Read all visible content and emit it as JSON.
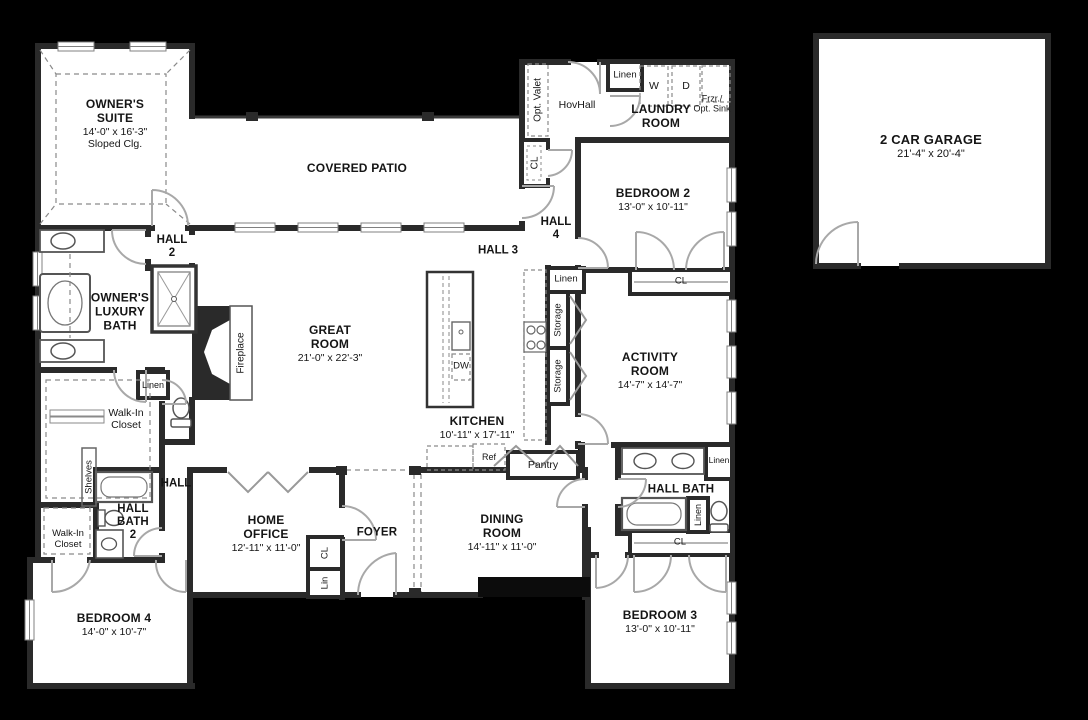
{
  "colors": {
    "background": "#000000",
    "floor": "#ffffff",
    "wall": "#2a2a2a",
    "door_swing": "#a8a8a8"
  },
  "rooms": {
    "owners_suite": {
      "name": "OWNER'S SUITE",
      "dims": "14'-0\" x 16'-3\"",
      "note": "Sloped Clg."
    },
    "covered_patio": {
      "name": "COVERED PATIO"
    },
    "laundry_room": {
      "name": "LAUNDRY ROOM"
    },
    "hovhall": {
      "name": "HovHall"
    },
    "bedroom_2": {
      "name": "BEDROOM 2",
      "dims": "13'-0\" x 10'-11\""
    },
    "great_room": {
      "name": "GREAT ROOM",
      "dims": "21'-0\" x 22'-3\""
    },
    "kitchen": {
      "name": "KITCHEN",
      "dims": "10'-11\" x 17'-11\""
    },
    "activity_room": {
      "name": "ACTIVITY ROOM",
      "dims": "14'-7\" x 14'-7\""
    },
    "owners_luxury_bath": {
      "name": "OWNER'S LUXURY BATH"
    },
    "walk_in_closet_owner": {
      "name": "Walk-In Closet"
    },
    "home_office": {
      "name": "HOME OFFICE",
      "dims": "12'-11\" x 11'-0\""
    },
    "foyer": {
      "name": "FOYER"
    },
    "dining_room": {
      "name": "DINING ROOM",
      "dims": "14'-11\" x 11'-0\""
    },
    "hall_bath": {
      "name": "HALL BATH"
    },
    "hall_bath_2": {
      "name": "HALL BATH 2"
    },
    "walk_in_closet_bed4": {
      "name": "Walk-In Closet"
    },
    "bedroom_3": {
      "name": "BEDROOM 3",
      "dims": "13'-0\" x 10'-11\""
    },
    "bedroom_4": {
      "name": "BEDROOM 4",
      "dims": "14'-0\" x 10'-7\""
    },
    "garage": {
      "name": "2 CAR GARAGE",
      "dims": "21'-4\" x 20'-4\""
    }
  },
  "halls": {
    "hall": "HALL",
    "hall_2": "HALL 2",
    "hall_3": "HALL 3",
    "hall_4": "HALL 4"
  },
  "closets": {
    "linen_laundry": "Linen",
    "linen_kitchen": "Linen",
    "linen_owner": "Linen",
    "linen_hall_bath_entry": "Linen",
    "linen_hall_bath": "Linen",
    "cl_hovhall": "CL",
    "cl_bedroom_2": "CL",
    "cl_bedroom_3": "CL",
    "cl_office": "CL",
    "lin_office": "Lin",
    "storage_upper": "Storage",
    "storage_lower": "Storage",
    "shelves": "Shelves",
    "pantry": "Pantry"
  },
  "fixtures": {
    "washer": "W",
    "dryer": "D",
    "freezer_line1": "Frzr./",
    "freezer_line2": "Opt. Sink",
    "opt_valet": "Opt. Valet",
    "dishwasher": "DW",
    "refrigerator": "Ref",
    "fireplace": "Fireplace"
  }
}
